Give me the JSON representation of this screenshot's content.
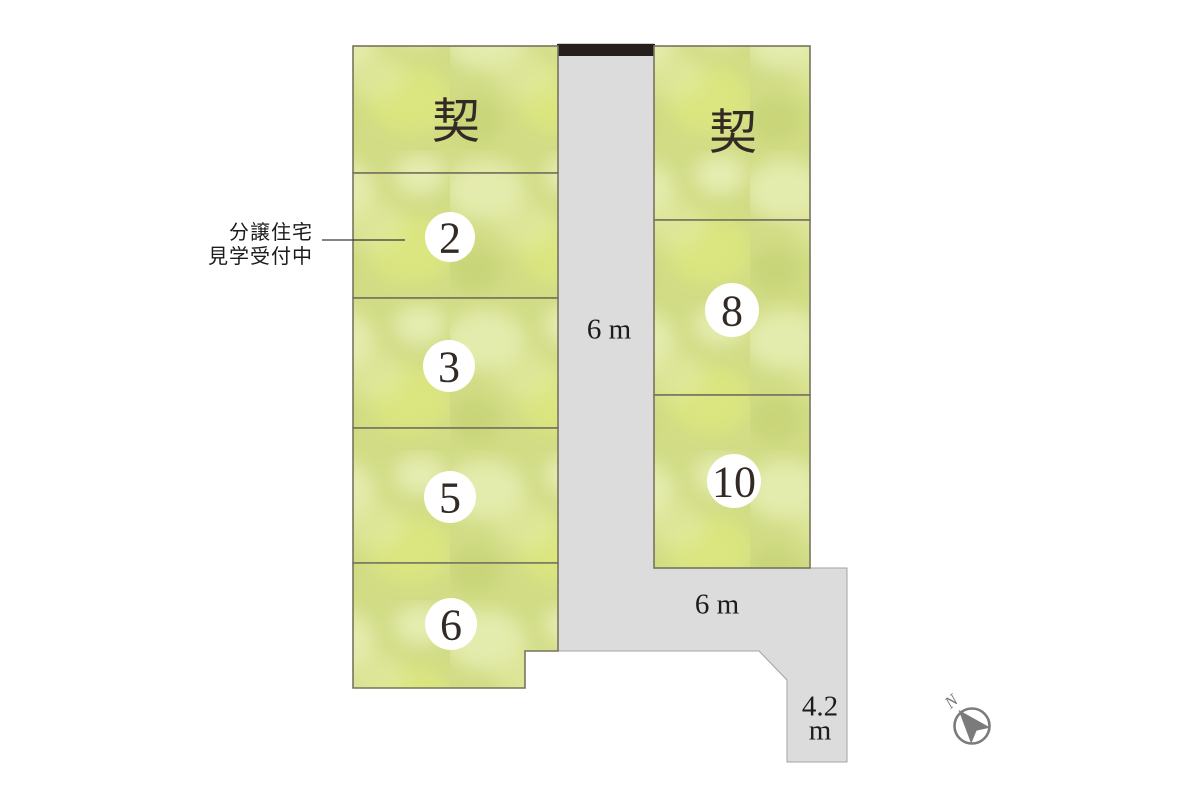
{
  "plan": {
    "annotation": {
      "line1": "分譲住宅",
      "line2": "見学受付中"
    },
    "lots_left": [
      {
        "label": "契",
        "status": "contracted"
      },
      {
        "label": "2",
        "status": "available"
      },
      {
        "label": "3",
        "status": "available"
      },
      {
        "label": "5",
        "status": "available"
      },
      {
        "label": "6",
        "status": "available"
      }
    ],
    "lots_right": [
      {
        "label": "契",
        "status": "contracted"
      },
      {
        "label": "8",
        "status": "available"
      },
      {
        "label": "10",
        "status": "available"
      }
    ],
    "roads": {
      "vertical_label": "6 m",
      "horizontal_label": "6 m",
      "narrow_value": "4.2",
      "narrow_unit": "m"
    },
    "compass": {
      "north_label": "N"
    },
    "colors": {
      "lot_green": "#d1dc85",
      "lot_green_light": "#e8efb4",
      "lot_border": "#79735f",
      "road_gray": "#dcdcdc",
      "road_edge": "#a6a39b",
      "boundary_bar": "#261f1d",
      "ink": "#332a26",
      "compass_gray": "#7b7b7b"
    }
  }
}
